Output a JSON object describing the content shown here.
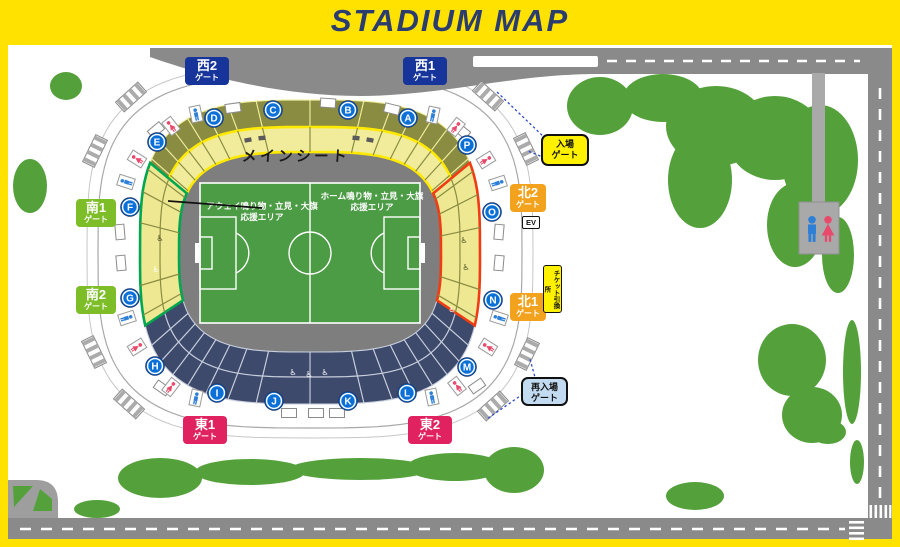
{
  "title": "STADIUM MAP",
  "stadium": {
    "main_seat_label": "メインシート",
    "away_area_line1": "アウェイ鳴り物・立見・大旗",
    "away_area_line2": "応援エリア",
    "home_area_line1": "ホーム鳴り物・立見・大旗",
    "home_area_line2": "応援エリア",
    "sections": [
      "A",
      "B",
      "C",
      "D",
      "E",
      "F",
      "G",
      "H",
      "I",
      "J",
      "K",
      "L",
      "M",
      "N",
      "O",
      "P"
    ]
  },
  "gates": [
    {
      "id": "west2",
      "line1": "西2",
      "line2": "ゲート"
    },
    {
      "id": "west1",
      "line1": "西1",
      "line2": "ゲート"
    },
    {
      "id": "south1",
      "line1": "南1",
      "line2": "ゲート"
    },
    {
      "id": "south2",
      "line1": "南2",
      "line2": "ゲート"
    },
    {
      "id": "east1",
      "line1": "東1",
      "line2": "ゲート"
    },
    {
      "id": "east2",
      "line1": "東2",
      "line2": "ゲート"
    },
    {
      "id": "north2",
      "line1": "北2",
      "line2": "ゲート"
    },
    {
      "id": "north1",
      "line1": "北1",
      "line2": "ゲート"
    }
  ],
  "labels": {
    "entrance_line1": "入場",
    "entrance_line2": "ゲート",
    "reentry_line1": "再入場",
    "reentry_line2": "ゲート",
    "ticket_exchange": "チケット引換所",
    "elevator": "EV"
  },
  "colors": {
    "frame": "#FFE200",
    "title": "#2B3C6F",
    "west_gate": "#16349A",
    "south_gate": "#7DBE28",
    "east_gate": "#E02360",
    "north_gate": "#F2A21C",
    "entrance_bg": "#FFF100",
    "reentry_bg": "#C2DBF0",
    "pitch": "#4C9B45",
    "upper_seats": "#8A8C42",
    "lower_seats": "#3E4A6B",
    "away_outline": "#00A650",
    "home_outline": "#F03C14",
    "tree": "#54A13C",
    "road": "#8A8A8A",
    "section_marker": "#0A70D8"
  }
}
